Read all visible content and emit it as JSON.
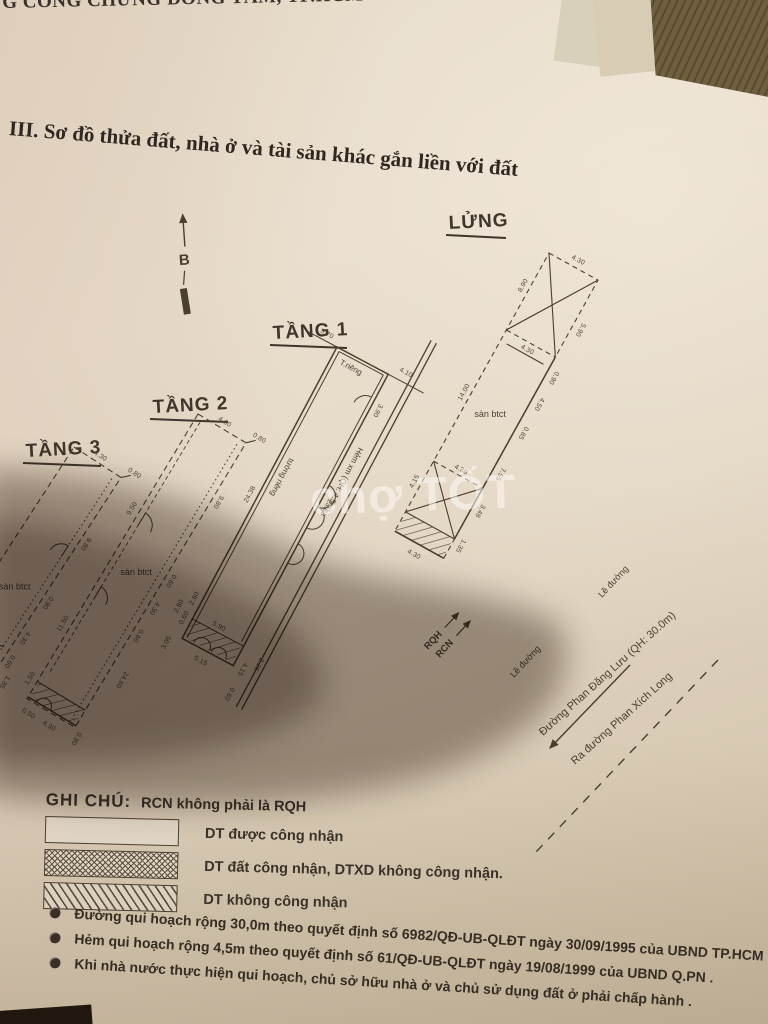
{
  "page": {
    "header_partial": "G CÔNG CHỨNG ĐỒNG TÂM, TP.HCM",
    "section_title": "III. Sơ đồ thửa đất, nhà ở và tài sản khác gắn liền với đất",
    "compass_label": "B",
    "watermark": "chợ TỐT"
  },
  "plans": {
    "lung": {
      "label": "LỬNG",
      "area": "sàn btct",
      "dims": [
        "4.30",
        "5.90",
        "8.90",
        "4.30",
        "0.90",
        "4.50",
        "14.00",
        "0.85",
        "7.55",
        "4.15",
        "3.48",
        "4.30",
        "4.30",
        "1.35"
      ]
    },
    "tang1": {
      "label": "TẦNG 1",
      "wall_top": "T.riêng",
      "wall": "tường riêng",
      "alley": "Hẻm xm (QH: 4.5m)",
      "marker_rqh": "RQH",
      "marker_rcn": "RCN",
      "curb": "Lề đường",
      "dims": [
        "5.70",
        "4.10",
        "3.90",
        "23.38",
        "24.38",
        "5.90",
        "5.15",
        "2.60",
        "0.60",
        "2.80",
        "3.05",
        "4.15",
        "2.26",
        "0.60"
      ]
    },
    "tang2": {
      "label": "TẦNG 2",
      "area": "sàn btct",
      "dims": [
        "4.30",
        "0.80",
        "9.80",
        "9.50",
        "0.60",
        "4.30",
        "0.60",
        "24.60",
        "11.50",
        "1.50",
        "0.50",
        "4.30",
        "0.80"
      ]
    },
    "tang3": {
      "label": "TẦNG 3",
      "area": "sàn btct",
      "terrace": "sân thượng",
      "dims": [
        "4.30",
        "0.80",
        "9.80",
        "17.40",
        "0.90",
        "4.30",
        "0.60",
        "1.85",
        "4.30",
        "10.94",
        "4.93",
        "1.90",
        "5.10"
      ]
    }
  },
  "streets": {
    "main": "Đường Phan Đăng Lưu (QH: 30.0m)",
    "secondary": "Ra đường Phan Xích Long",
    "curb_lung": "Lề đường"
  },
  "legend": {
    "title": "GHI CHÚ:",
    "note": "RCN không phải là RQH",
    "items": [
      "DT được công nhận",
      "DT đất công nhận, DTXD  không công nhận.",
      "DT không công nhận"
    ]
  },
  "notes": [
    "Đường qui hoạch rộng 30,0m theo quyết định số 6982/QĐ-UB-QLĐT ngày 30/09/1995 của UBND TP.HCM .",
    "Hẻm qui hoạch rộng 4,5m theo quyết định số 61/QĐ-UB-QLĐT ngày 19/08/1999 của UBND Q.PN .",
    "Khi nhà nước thực hiện qui hoạch, chủ sở hữu nhà ở và chủ sử dụng đất ở phải chấp hành ."
  ],
  "colors": {
    "ink": "#4a3e2f",
    "paper": "#e4d8c6",
    "shadow": "#5a4836",
    "wood": "#6f5f3e"
  }
}
